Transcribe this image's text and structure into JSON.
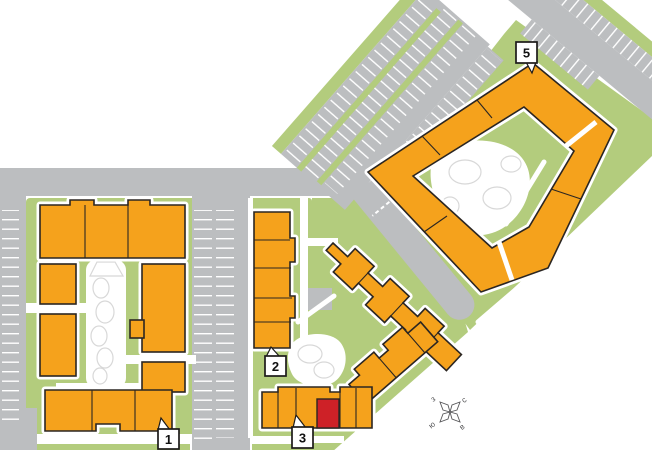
{
  "map": {
    "type": "residential-site-plan",
    "buildings": [
      {
        "id": "1",
        "marker": "1",
        "highlighted": false
      },
      {
        "id": "2",
        "marker": "2",
        "highlighted": false
      },
      {
        "id": "3",
        "marker": "3",
        "highlighted": true
      },
      {
        "id": "5",
        "marker": "5",
        "highlighted": false
      }
    ],
    "highlighted_unit": {
      "building": "3",
      "color": "#ce2127"
    },
    "compass": {
      "north": "с",
      "east": "в",
      "south": "ю",
      "west": "з"
    },
    "colors": {
      "green": "#b3cc7d",
      "road": "#bcbec0",
      "building": "#f5a21c",
      "outline": "#2b2622",
      "highlight": "#ce2127",
      "white": "#ffffff",
      "deco": "#d8d8d8",
      "markerBorder": "#1c1a19",
      "markerText": "#111111",
      "compassInk": "#58585a"
    }
  }
}
